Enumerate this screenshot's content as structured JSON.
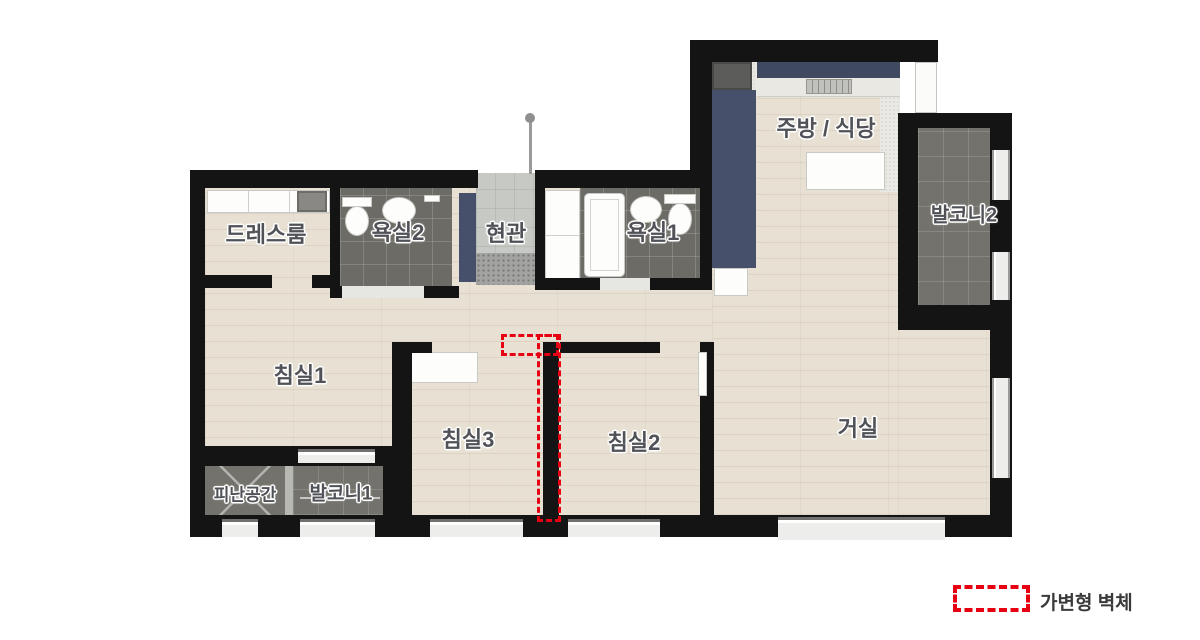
{
  "rooms": [
    {
      "id": "dressroom",
      "label": "드레스룸"
    },
    {
      "id": "bath2",
      "label": "욕실2"
    },
    {
      "id": "entrance",
      "label": "현관"
    },
    {
      "id": "bath1",
      "label": "욕실1"
    },
    {
      "id": "kitchen",
      "label": "주방 / 식당"
    },
    {
      "id": "balcony2",
      "label": "발코니2"
    },
    {
      "id": "bedroom1",
      "label": "침실1"
    },
    {
      "id": "bedroom3",
      "label": "침실3"
    },
    {
      "id": "bedroom2",
      "label": "침실2"
    },
    {
      "id": "living",
      "label": "거실"
    },
    {
      "id": "refuge",
      "label": "피난공간"
    },
    {
      "id": "balcony1",
      "label": "발코니1"
    }
  ],
  "legend": {
    "label": "가변형 벽체"
  },
  "colors": {
    "variable_wall_red": "#e60012",
    "wall": "#141414",
    "wood_floor": "#e7e0d3",
    "bath_tile": "#6c6b65",
    "balcony_tile": "#73726c",
    "entrance_tile": "#c7cac4",
    "kitchen_cabinet_navy": "#3f4a61"
  }
}
